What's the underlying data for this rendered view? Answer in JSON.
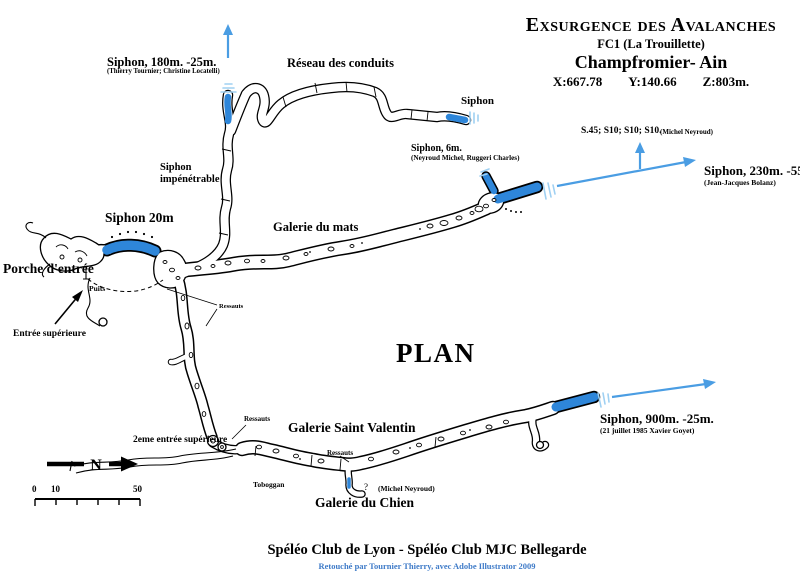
{
  "colors": {
    "siphon_fill": "#2e86d9",
    "arrow_blue": "#4a9de3",
    "hash_blue": "#9fd0f2",
    "footer_credit_blue": "#3f7bc8",
    "ink": "#000000"
  },
  "title_block": {
    "title": "Exsurgence des Avalanches",
    "code_line": "FC1  (La Trouillette)",
    "commune": "Champfromier- Ain",
    "coord_x": "X:667.78",
    "coord_y": "Y:140.66",
    "coord_z": "Z:803m."
  },
  "plan_label": "PLAN",
  "compass": {
    "label": "N"
  },
  "scale_bar": {
    "start": "0",
    "second": "10",
    "end": "50"
  },
  "annotations": {
    "siphon_180": {
      "title": "Siphon, 180m. -25m.",
      "credit": "(Thierry Tournier; Christine Locatelli)"
    },
    "reseau_conduits": {
      "title": "Réseau des conduits"
    },
    "siphon_top": {
      "title": "Siphon"
    },
    "siphon_6m": {
      "title": "Siphon, 6m.",
      "credit": "(Neyroud Michel, Ruggeri Charles)"
    },
    "s45": {
      "title": "S.45; S10; S10; S10.",
      "credit": "(Michel Neyroud)"
    },
    "siphon_230": {
      "title": "Siphon, 230m. -55m.",
      "credit": "(Jean-Jacques Bolanz)"
    },
    "siphon_impenetrable": {
      "line1": "Siphon",
      "line2": "impénétrable"
    },
    "siphon_20m": {
      "title": "Siphon 20m"
    },
    "porche_entree": {
      "title": "Porche d'entrée"
    },
    "puits": {
      "title": "Puits"
    },
    "entree_superieure": {
      "title": "Entrée supérieure"
    },
    "galerie_du_mats": {
      "title": "Galerie du mats"
    },
    "ressauts_center": {
      "title": "Ressauts"
    },
    "ressauts_left": {
      "title": "Ressauts"
    },
    "deuxieme_entree": {
      "title": "2eme  entrée supérieure"
    },
    "galerie_saint_valentin": {
      "title": "Galerie Saint Valentin"
    },
    "ressauts_bottom": {
      "title": "Ressauts"
    },
    "toboggan": {
      "title": "Toboggan"
    },
    "question_mark": {
      "title": "?",
      "credit": "(Michel Neyroud)"
    },
    "galerie_du_chien": {
      "title": "Galerie du Chien"
    },
    "siphon_900": {
      "title": "Siphon, 900m. -25m.",
      "credit": "(21 juillet 1985 Xavier Goyet)"
    }
  },
  "footer": {
    "clubs": "Spéléo Club de Lyon - Spéléo Club MJC Bellegarde",
    "credit": "Retouché par Tournier Thierry, avec Adobe Illustrator 2009"
  }
}
